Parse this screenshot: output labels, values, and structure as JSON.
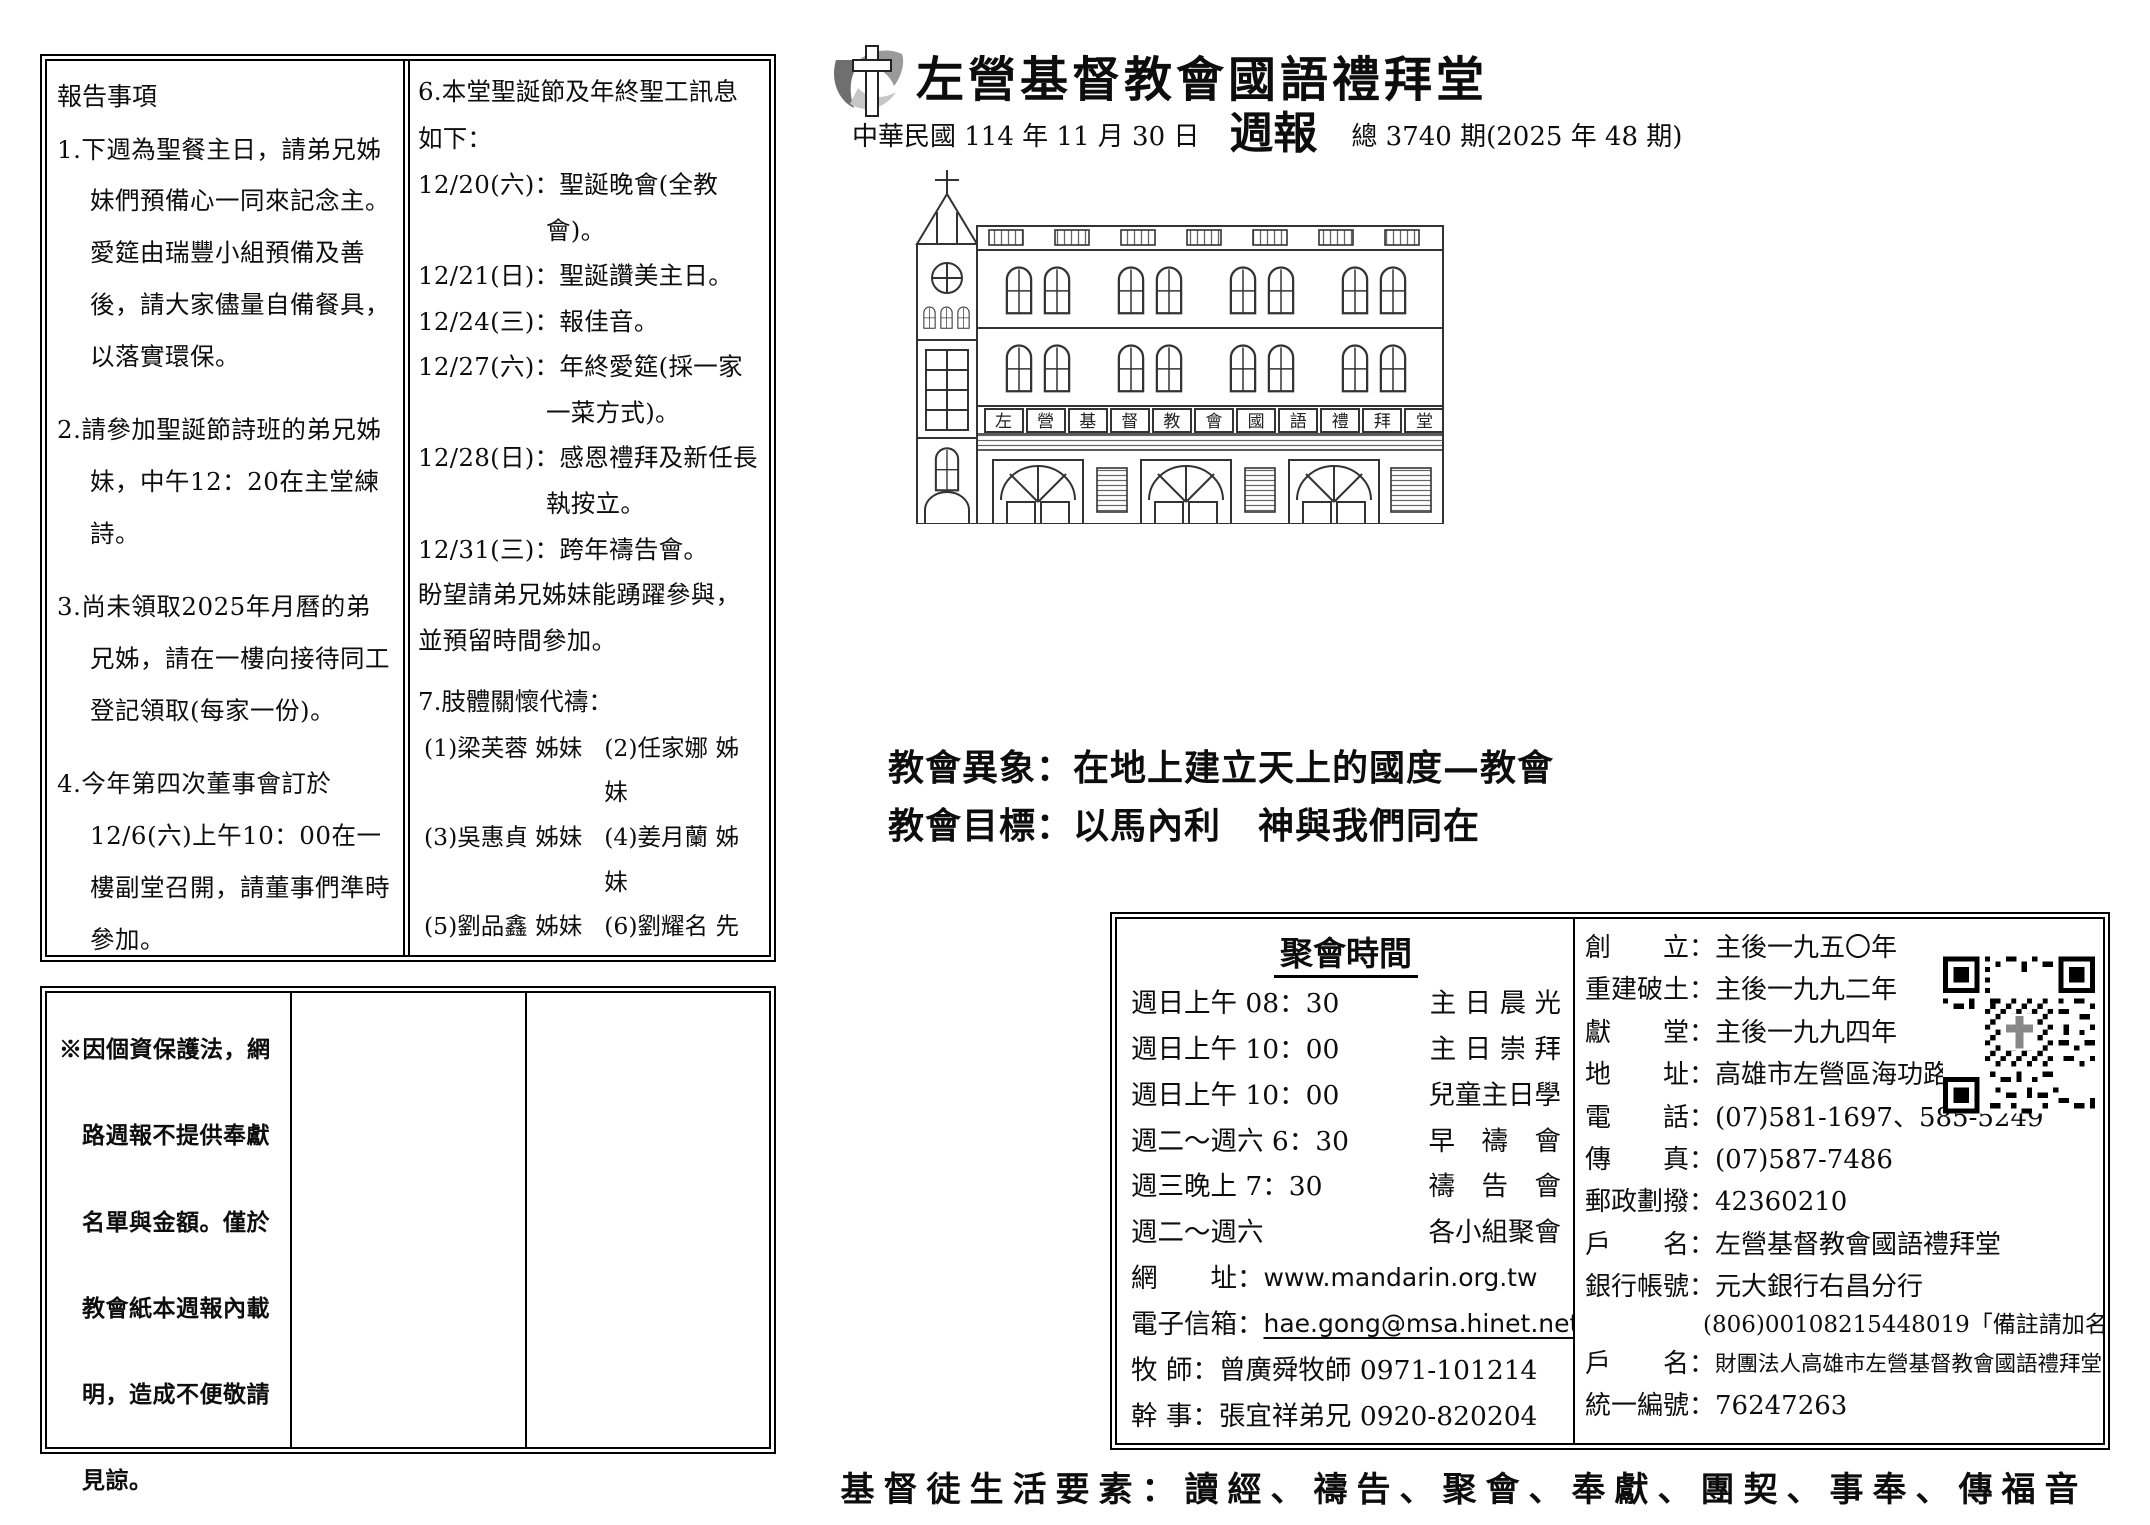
{
  "p1": {
    "box1": {
      "title": "報告事項",
      "items": [
        {
          "num": "1.",
          "text": "下週為聖餐主日，請弟兄姊妹們預備心一同來記念主。愛筵由瑞豐小組預備及善後，請大家儘量自備餐具，以落實環保。"
        },
        {
          "num": "2.",
          "text": "請參加聖誕節詩班的弟兄姊妹，中午12：20在主堂練詩。"
        },
        {
          "num": "3.",
          "text": "尚未領取2025年月曆的弟兄姊，請在一樓向接待同工登記領取(每家一份)。"
        },
        {
          "num": "4.",
          "text": "今年第四次董事會訂於12/6(六)上午10：00在一樓副堂召開，請董事們準時參加。"
        },
        {
          "num": "5.",
          "text": "十二月份服務表，已公布於一樓公布欄，請服事同工關心與確認。"
        }
      ],
      "item6": {
        "head": "6.本堂聖誕節及年終聖工訊息如下：",
        "schedule": [
          "12/20(六)：聖誕晚會(全教會)。",
          "12/21(日)：聖誕讚美主日。",
          "12/24(三)：報佳音。",
          "12/27(六)：年終愛筵(採一家一菜方式)。",
          "12/28(日)：感恩禮拜及新任長執按立。",
          "12/31(三)：跨年禱告會。"
        ],
        "tail": "盼望請弟兄姊妹能踴躍參與，並預留時間參加。"
      },
      "item7": {
        "head": "7.肢體關懷代禱：",
        "names": [
          "(1)梁芙蓉 姊妹",
          "(2)任家娜 姊妹",
          "(3)吳惠貞 姊妹",
          "(4)姜月蘭 姊妹",
          "(5)劉品鑫 姊妹",
          "(6)劉耀名 先生"
        ],
        "prayer": "願　神賜下平安、喜樂，經歷上帝的醫治與恩典。"
      }
    },
    "box2": {
      "note": "※因個資保護法，網路週報不提供奉獻名單與金額。僅於教會紙本週報內載明，造成不便敬請見諒。"
    }
  },
  "p2": {
    "header": {
      "church_name": "左營基督教會國語禮拜堂",
      "date": "中華民國 114 年 11 月 30 日",
      "bulletin": "週報",
      "issue": "總 3740 期(2025 年 48 期)"
    },
    "building": {
      "banner": "左營基督教會國語禮拜堂"
    },
    "vision": {
      "line1": "教會異象：在地上建立天上的國度—教會",
      "line2": "教會目標：以馬內利　神與我們同在"
    },
    "meetings": {
      "title": "聚會時間",
      "rows": [
        {
          "time": "週日上午 08：30",
          "name": "主 日 晨 光"
        },
        {
          "time": "週日上午 10：00",
          "name": "主 日 崇 拜"
        },
        {
          "time": "週日上午 10：00",
          "name": "兒童主日學"
        },
        {
          "time": "週二～週六 6：30",
          "name": "早　禱　會"
        },
        {
          "time": "週三晚上  7：30",
          "name": "禱　告　會"
        },
        {
          "time": "週二～週六",
          "name": "各小組聚會"
        }
      ],
      "contacts": [
        {
          "label": "網　　址：",
          "value": "www.mandarin.org.tw"
        },
        {
          "label": "電子信箱：",
          "value": "hae.gong@msa.hinet.net"
        },
        {
          "label": "牧 師：",
          "value": "曾廣舜牧師 0971-101214"
        },
        {
          "label": "幹 事：",
          "value": "張宜祥弟兄 0920-820204"
        }
      ]
    },
    "details": {
      "rows": [
        {
          "label": "創　　立：",
          "value": "主後一九五〇年"
        },
        {
          "label": "重建破土：",
          "value": "主後一九九二年"
        },
        {
          "label": "獻　　堂：",
          "value": "主後一九九四年"
        },
        {
          "label": "地　　址：",
          "value": "高雄市左營區海功路 243 號"
        },
        {
          "label": "電　　話：",
          "value": "(07)581-1697、585-5249"
        },
        {
          "label": "傳　　真：",
          "value": "(07)587-7486"
        },
        {
          "label": "郵政劃撥：",
          "value": "42360210"
        },
        {
          "label": "戶　　名：",
          "value": "左營基督教會國語禮拜堂"
        },
        {
          "label": "銀行帳號：",
          "value": "元大銀行右昌分行"
        },
        {
          "label": "",
          "value": "(806)00108215448019「備註請加名字」"
        },
        {
          "label": "戶　　名：",
          "value": "財團法人高雄市左營基督教會國語禮拜堂"
        },
        {
          "label": "統一編號：",
          "value": "76247263"
        }
      ]
    },
    "footer": "基督徒生活要素：讀經、禱告、聚會、奉獻、團契、事奉、傳福音"
  }
}
